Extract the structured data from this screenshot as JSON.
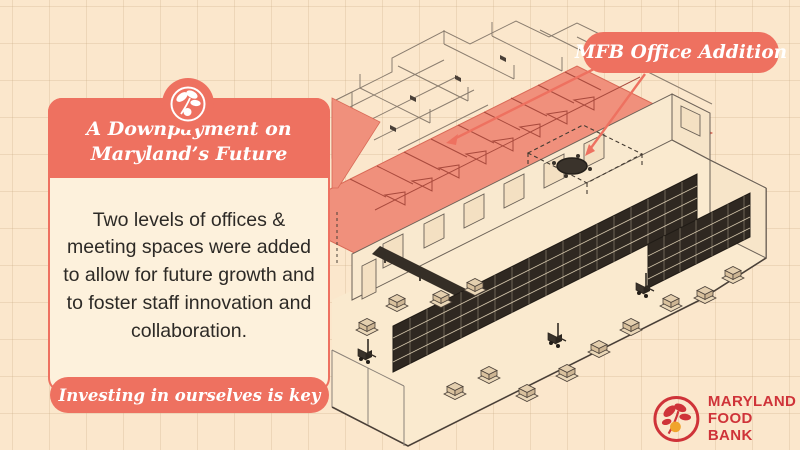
{
  "card": {
    "header_line1": "A Downpayment on",
    "header_line2": "Maryland’s Future",
    "body": "Two levels of offices & meeting spaces were added to allow for future growth and to foster staff innovation and collaboration.",
    "footer": "Investing in ourselves is key"
  },
  "callout": {
    "label": "MFB Office Addition"
  },
  "logo": {
    "line1": "MARYLAND",
    "line2": "FOOD BANK"
  },
  "diagram": {
    "description": "Isometric line drawing of the Maryland Food Bank warehouse with two-level office addition highlighted",
    "highlighted_area": "MFB Office Addition"
  },
  "colors": {
    "salmon": "#ee7160",
    "salmon_fill": "#f0907c",
    "background_cream": "#fbe7cc",
    "card_cream": "#fdf1dc",
    "ink": "#4a4038",
    "logo_red": "#cf3339",
    "logo_yellow": "#f0a42c"
  }
}
